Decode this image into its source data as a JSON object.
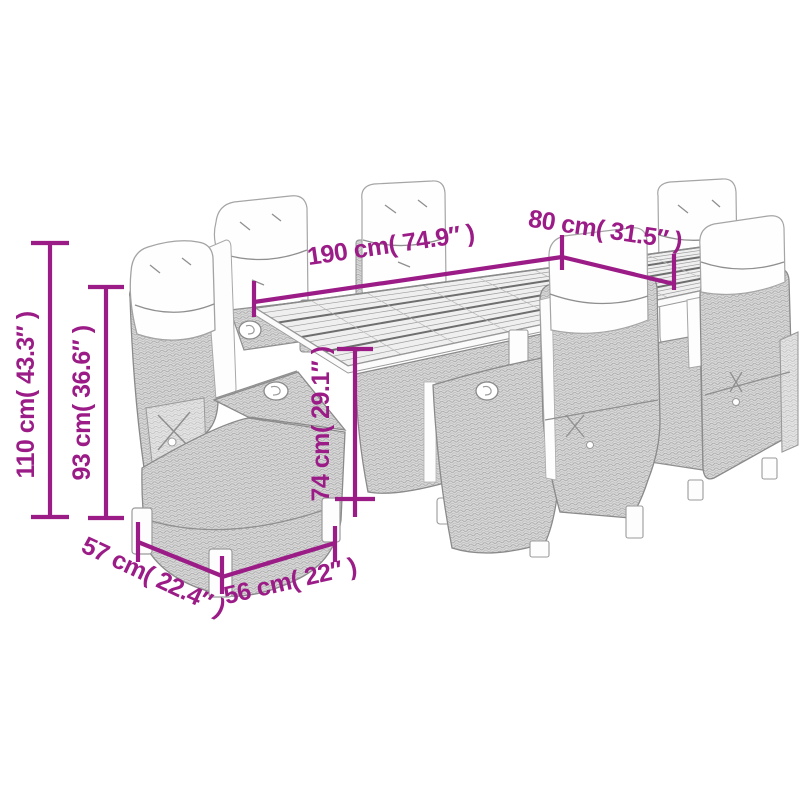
{
  "image": {
    "subject": "Line-art dimension diagram of a garden dining set: slatted-top table with six reclining wicker chairs and white cushions",
    "background": "#ffffff",
    "accent_color": "#9b1c87",
    "line_art_color": "#8a8a8a",
    "dimensions": [
      {
        "name": "table-length",
        "text": "190 cm( 74.9″ )"
      },
      {
        "name": "table-width",
        "text": "80 cm( 31.5″ )"
      },
      {
        "name": "chair-height",
        "text": "110 cm( 43.3″ )"
      },
      {
        "name": "chair-back-height",
        "text": "93 cm( 36.6″ )"
      },
      {
        "name": "table-height",
        "text": "74 cm( 29.1″ )"
      },
      {
        "name": "chair-seat-depth",
        "text": "57 cm( 22.4″ )"
      },
      {
        "name": "chair-seat-width",
        "text": "56 cm( 22″ )"
      }
    ]
  }
}
